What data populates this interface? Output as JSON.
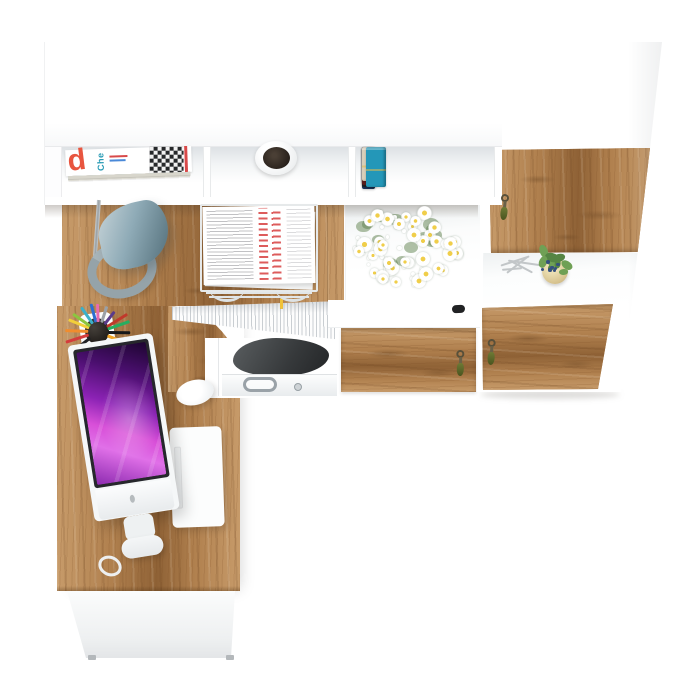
{
  "scene": {
    "description": "Top view 3D render of an L-shaped white and oak home office set: wall hutch with magazines, plant pot and books, tall oak-door cabinet with keys, sideboard shelf with daisy bouquet, and corner desk with monitor, keyboard, mouse, desk lamp, letter tray, document files and printer."
  },
  "palette": {
    "background": "#ffffff",
    "furniture_white": "#ffffff",
    "oak": "#b0804e",
    "oak_dark": "#8f6236",
    "oak_light": "#c79b6a",
    "lamp_blue_gray": "#8fabb7",
    "screen_magenta": "#d84fd8",
    "daisy_center": "#f0ce4a",
    "paper_red": "#dd5c5c",
    "key_tassel_olive": "#6e7a35"
  },
  "hutch": {
    "magazine_stack": {
      "big_letter": "d",
      "side_text": "Che",
      "letter_color": "#e8553f",
      "side_text_color": "#2a9bb5",
      "edge_stripes": [
        "#f2efe6",
        "#e8d44a",
        "#ffffff",
        "#df4f88",
        "#f7f7f3",
        "#5ab6c6",
        "#efede4",
        "#d8d6cc"
      ]
    },
    "pot": {
      "rim": "#ffffff",
      "soil": "#2e2521"
    },
    "books": [
      {
        "color": "#8e2f2f",
        "height": 36,
        "width": 10
      },
      {
        "color": "#1d3a63",
        "height": 42,
        "width": 13
      },
      {
        "color": "#2e6db4",
        "height": 38,
        "width": 14
      },
      {
        "color": "#23242a",
        "height": 40,
        "width": 15
      },
      {
        "color": "#2f7a33",
        "height": 36,
        "width": 13
      },
      {
        "color": "#5e1f1f",
        "height": 38,
        "width": 13
      },
      {
        "color": "#d9cfba",
        "height": 34,
        "width": 11
      },
      {
        "color": "#2497b8",
        "height": 40,
        "width": 20
      }
    ]
  },
  "sideboard": {
    "daisy_count": 40,
    "bud_count": 26,
    "leaf_count": 14,
    "knob_color": "#212224"
  },
  "right_cabinet": {
    "door_count": 3,
    "key_count": 3,
    "plant": {
      "pot": "#d6c28e",
      "leaf": "#558544",
      "leaf_light": "#6fa055",
      "berry": "#35507e"
    }
  },
  "desk": {
    "pencil_colors": [
      "#222327",
      "#d43c3c",
      "#f08c2e",
      "#f2cf3a",
      "#8cc63f",
      "#3bb0c9",
      "#2f6fd0",
      "#e86ab0",
      "#9aa0a6",
      "#5a3b8a",
      "#c0392b",
      "#27ae60",
      "#17181a",
      "#f5a623"
    ],
    "file_tab_colors": [
      "#8a4fc8",
      "#d8359c",
      "#ef6aa8",
      "#e03a3a",
      "#f08c2e",
      "#f3d03a",
      "#a8d04a",
      "#3da856",
      "#2fb3b0",
      "#3a7ad0",
      "#6ab8ea",
      "#9a5fd0",
      "#e04545",
      "#f0c23a"
    ],
    "keyboard": {
      "cols": 5,
      "rows": 14
    },
    "mag_stripe_heights": [
      5,
      4,
      6,
      4,
      5,
      4,
      5,
      4
    ]
  }
}
